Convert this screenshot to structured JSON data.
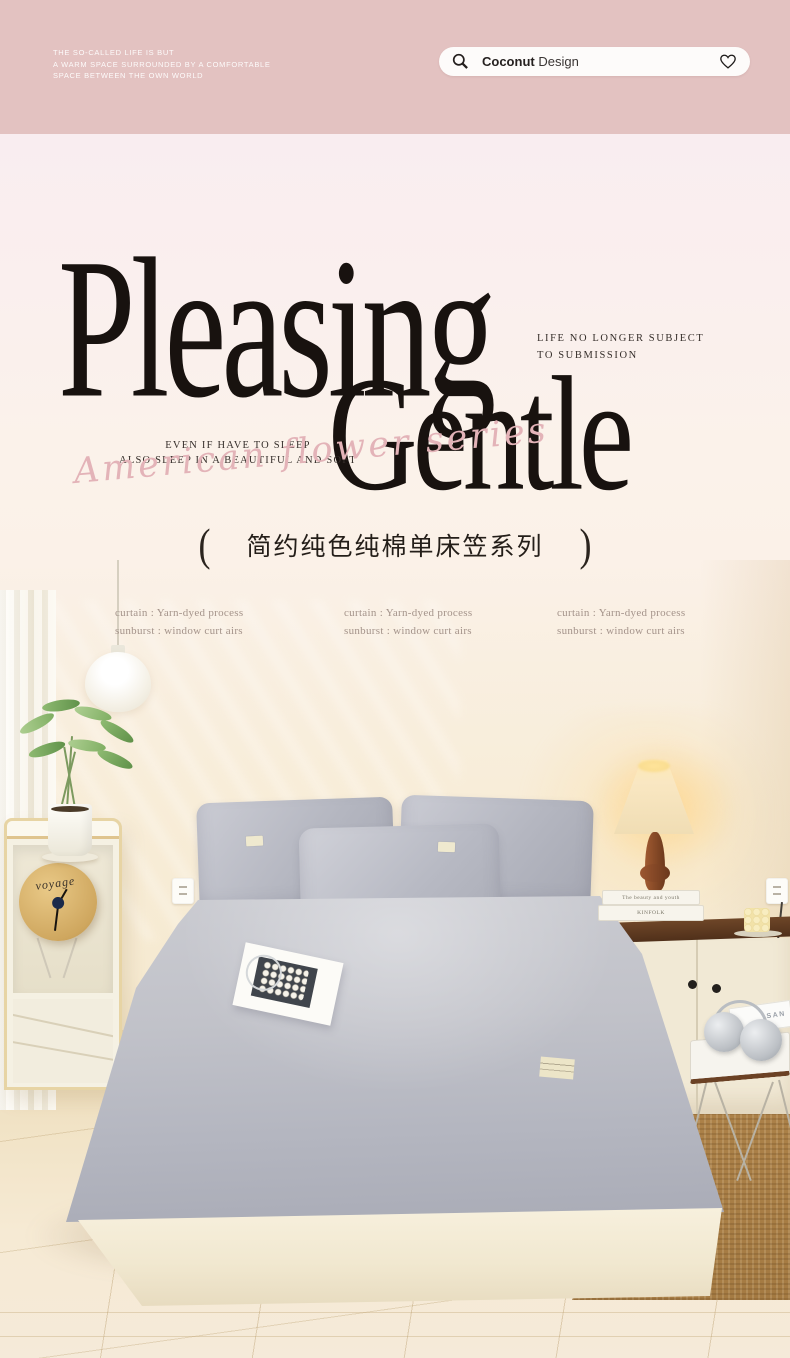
{
  "header": {
    "bg_color": "#e3c2c1",
    "tagline_lines": [
      "THE SO-CALLED LIFE IS BUT",
      "A WARM SPACE SURROUNDED BY A COMFORTABLE",
      "SPACE BETWEEN THE OWN WORLD"
    ],
    "search": {
      "brand_bold": "Coconut",
      "brand_rest": " Design"
    }
  },
  "hero": {
    "title_line1": "Pleasing",
    "title_line2": "Gentle",
    "caption_right_line1": "LIFE NO  LONGER SUBJECT",
    "caption_right_line2": "TO SUBMISSION",
    "caption_left_line1": "EVEN IF HAVE TO SLEEP",
    "caption_left_line2": "ALSO SLEEP IN A BEAUTIFUL AND SOFT",
    "script_text": "American flower series",
    "script_color": "#e3b3b8",
    "series": {
      "bracket_open": "(",
      "title": "简约纯色纯棉单床笠系列",
      "bracket_close": ")"
    }
  },
  "specs": {
    "columns": [
      {
        "line1": "curtain : Yarn-dyed process",
        "line2": "sunburst : window curt airs"
      },
      {
        "line1": "curtain : Yarn-dyed process",
        "line2": "sunburst : window curt airs"
      },
      {
        "line1": "curtain : Yarn-dyed process",
        "line2": "sunburst : window curt airs"
      }
    ]
  },
  "scene": {
    "clock_label": "voyage",
    "book_top_label": "The beauty and youth",
    "book_bottom_label": "KINFOLK",
    "magazine_label": "SAN",
    "palette": {
      "wall": "#f8edd9",
      "sheet_gray": "#b9bbc4",
      "bed_base_cream": "#f3ecd9",
      "rug_brown": "#aa8047",
      "wood_dark": "#5d3c25",
      "lamp_glow": "#ffd98f"
    }
  }
}
